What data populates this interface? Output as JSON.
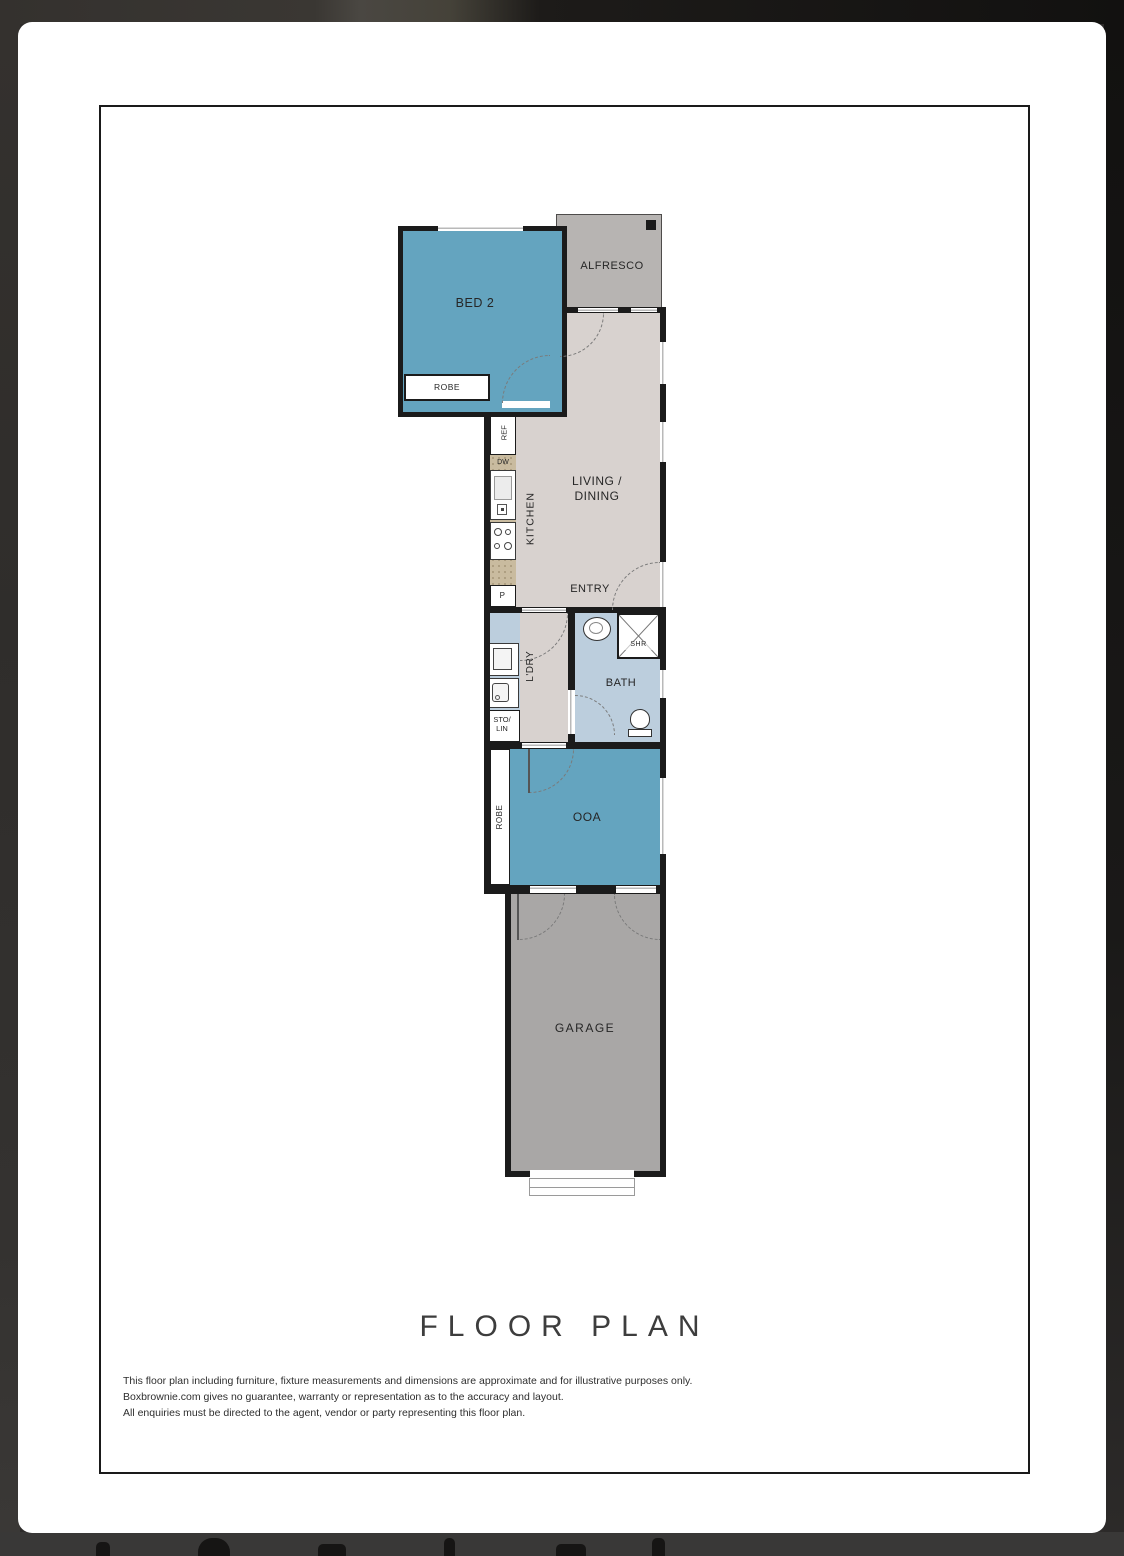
{
  "document": {
    "title": "FLOOR PLAN",
    "disclaimer": {
      "line1": "This floor plan including furniture, fixture measurements and dimensions are approximate and for illustrative purposes only.",
      "line2": "Boxbrownie.com gives no guarantee, warranty or representation as to the accuracy and layout.",
      "line3": "All enquiries must be directed to the agent, vendor or party representing this floor plan."
    }
  },
  "rooms": {
    "bed2": {
      "label": "BED 2",
      "color": "#64a4bf"
    },
    "alfresco": {
      "label": "ALFRESCO",
      "color": "#b7b4b2"
    },
    "living_dining": {
      "label": "LIVING /\nDINING",
      "color": "#d8d2cf"
    },
    "kitchen": {
      "label": "KITCHEN"
    },
    "entry": {
      "label": "ENTRY"
    },
    "laundry": {
      "label": "L'DRY",
      "color": "#bccedd"
    },
    "bath": {
      "label": "BATH",
      "color": "#bccedd"
    },
    "bed1": {
      "label": "OOA",
      "color": "#64a4bf"
    },
    "garage": {
      "label": "GARAGE",
      "color": "#a9a7a6"
    }
  },
  "fixtures": {
    "fridge": "REF",
    "dishwasher": "DW",
    "pantry": "P",
    "shower": "SHR",
    "storage_linen": "STO/\nLIN",
    "robe_bed2": "ROBE",
    "robe_bed1": "ROBE"
  },
  "colors": {
    "wall": "#1b1b1b",
    "counter": "#c9bb9f",
    "page_background": "#ffffff",
    "frame_background": "#2d2b2a",
    "footer_strip": "#393837",
    "label_text": "#262626"
  }
}
